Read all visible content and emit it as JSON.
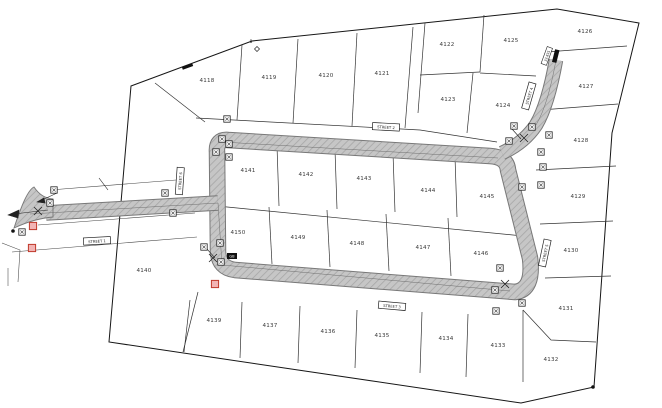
{
  "map": {
    "title": "subdivision-plat-map",
    "lots": [
      {
        "id": "4118",
        "x": 207,
        "y": 82
      },
      {
        "id": "4119",
        "x": 269,
        "y": 79
      },
      {
        "id": "4120",
        "x": 326,
        "y": 77
      },
      {
        "id": "4121",
        "x": 382,
        "y": 75
      },
      {
        "id": "4122",
        "x": 447,
        "y": 46
      },
      {
        "id": "4123",
        "x": 448,
        "y": 101
      },
      {
        "id": "4124",
        "x": 503,
        "y": 107
      },
      {
        "id": "4125",
        "x": 511,
        "y": 42
      },
      {
        "id": "4126",
        "x": 585,
        "y": 33
      },
      {
        "id": "4127",
        "x": 586,
        "y": 88
      },
      {
        "id": "4128",
        "x": 581,
        "y": 142
      },
      {
        "id": "4129",
        "x": 578,
        "y": 198
      },
      {
        "id": "4130",
        "x": 571,
        "y": 252
      },
      {
        "id": "4131",
        "x": 566,
        "y": 310
      },
      {
        "id": "4132",
        "x": 551,
        "y": 361
      },
      {
        "id": "4133",
        "x": 498,
        "y": 347
      },
      {
        "id": "4134",
        "x": 446,
        "y": 340
      },
      {
        "id": "4135",
        "x": 382,
        "y": 337
      },
      {
        "id": "4136",
        "x": 328,
        "y": 333
      },
      {
        "id": "4137",
        "x": 270,
        "y": 327
      },
      {
        "id": "4139",
        "x": 214,
        "y": 322
      },
      {
        "id": "4140",
        "x": 144,
        "y": 272
      },
      {
        "id": "4141",
        "x": 248,
        "y": 172
      },
      {
        "id": "4142",
        "x": 306,
        "y": 176
      },
      {
        "id": "4143",
        "x": 364,
        "y": 180
      },
      {
        "id": "4144",
        "x": 428,
        "y": 192
      },
      {
        "id": "4145",
        "x": 487,
        "y": 198
      },
      {
        "id": "4146",
        "x": 481,
        "y": 255
      },
      {
        "id": "4147",
        "x": 423,
        "y": 249
      },
      {
        "id": "4148",
        "x": 357,
        "y": 245
      },
      {
        "id": "4149",
        "x": 298,
        "y": 239
      },
      {
        "id": "4150",
        "x": 238,
        "y": 234
      }
    ],
    "streets": [
      {
        "name": "STREET 1",
        "x": 97,
        "y": 241,
        "angle": -3
      },
      {
        "name": "STREET 2",
        "x": 386,
        "y": 127,
        "angle": 3
      },
      {
        "name": "STREET 3",
        "x": 392,
        "y": 306,
        "angle": 5
      },
      {
        "name": "STREET 4",
        "x": 529,
        "y": 96,
        "angle": -74
      },
      {
        "name": "STREET 5",
        "x": 545,
        "y": 253,
        "angle": -78
      },
      {
        "name": "STREET 6",
        "x": 180,
        "y": 181,
        "angle": -86
      }
    ],
    "annotations": {
      "dimension": {
        "text": "33.835",
        "x": 547,
        "y": 56,
        "angle": -70
      },
      "corner_monument": {
        "text": "8",
        "x": 251,
        "y": 43
      },
      "road_plate": {
        "text": "GB",
        "x": 232,
        "y": 256
      }
    },
    "markers": {
      "standard": [
        {
          "x": 54,
          "y": 190
        },
        {
          "x": 50,
          "y": 203
        },
        {
          "x": 22,
          "y": 232
        },
        {
          "x": 165,
          "y": 193
        },
        {
          "x": 173,
          "y": 213
        },
        {
          "x": 227,
          "y": 119
        },
        {
          "x": 222,
          "y": 139
        },
        {
          "x": 229,
          "y": 144
        },
        {
          "x": 216,
          "y": 152
        },
        {
          "x": 229,
          "y": 157
        },
        {
          "x": 220,
          "y": 243
        },
        {
          "x": 204,
          "y": 247
        },
        {
          "x": 221,
          "y": 262
        },
        {
          "x": 500,
          "y": 268
        },
        {
          "x": 514,
          "y": 126
        },
        {
          "x": 532,
          "y": 127
        },
        {
          "x": 549,
          "y": 135
        },
        {
          "x": 509,
          "y": 141
        },
        {
          "x": 541,
          "y": 152
        },
        {
          "x": 543,
          "y": 167
        },
        {
          "x": 541,
          "y": 185
        },
        {
          "x": 522,
          "y": 187
        },
        {
          "x": 495,
          "y": 290
        },
        {
          "x": 522,
          "y": 303
        },
        {
          "x": 496,
          "y": 311
        }
      ],
      "highlighted": [
        {
          "x": 33,
          "y": 226
        },
        {
          "x": 32,
          "y": 248
        },
        {
          "x": 215,
          "y": 284
        }
      ],
      "crosses": [
        {
          "x": 213,
          "y": 258
        },
        {
          "x": 524,
          "y": 138
        },
        {
          "x": 38,
          "y": 211
        },
        {
          "x": 505,
          "y": 284
        }
      ],
      "dots": [
        {
          "x": 13,
          "y": 231
        },
        {
          "x": 593,
          "y": 387
        }
      ]
    },
    "colors": {
      "road_fill": "#c6c6c6",
      "road_hatch": "#a8a8a8",
      "road_edge": "#787878",
      "boundary": "#161616",
      "parcel_line": "#333333",
      "lot_text": "#3a3a3a",
      "highlight_stroke": "#c0392b",
      "highlight_fill": "#f2b4b4"
    }
  }
}
